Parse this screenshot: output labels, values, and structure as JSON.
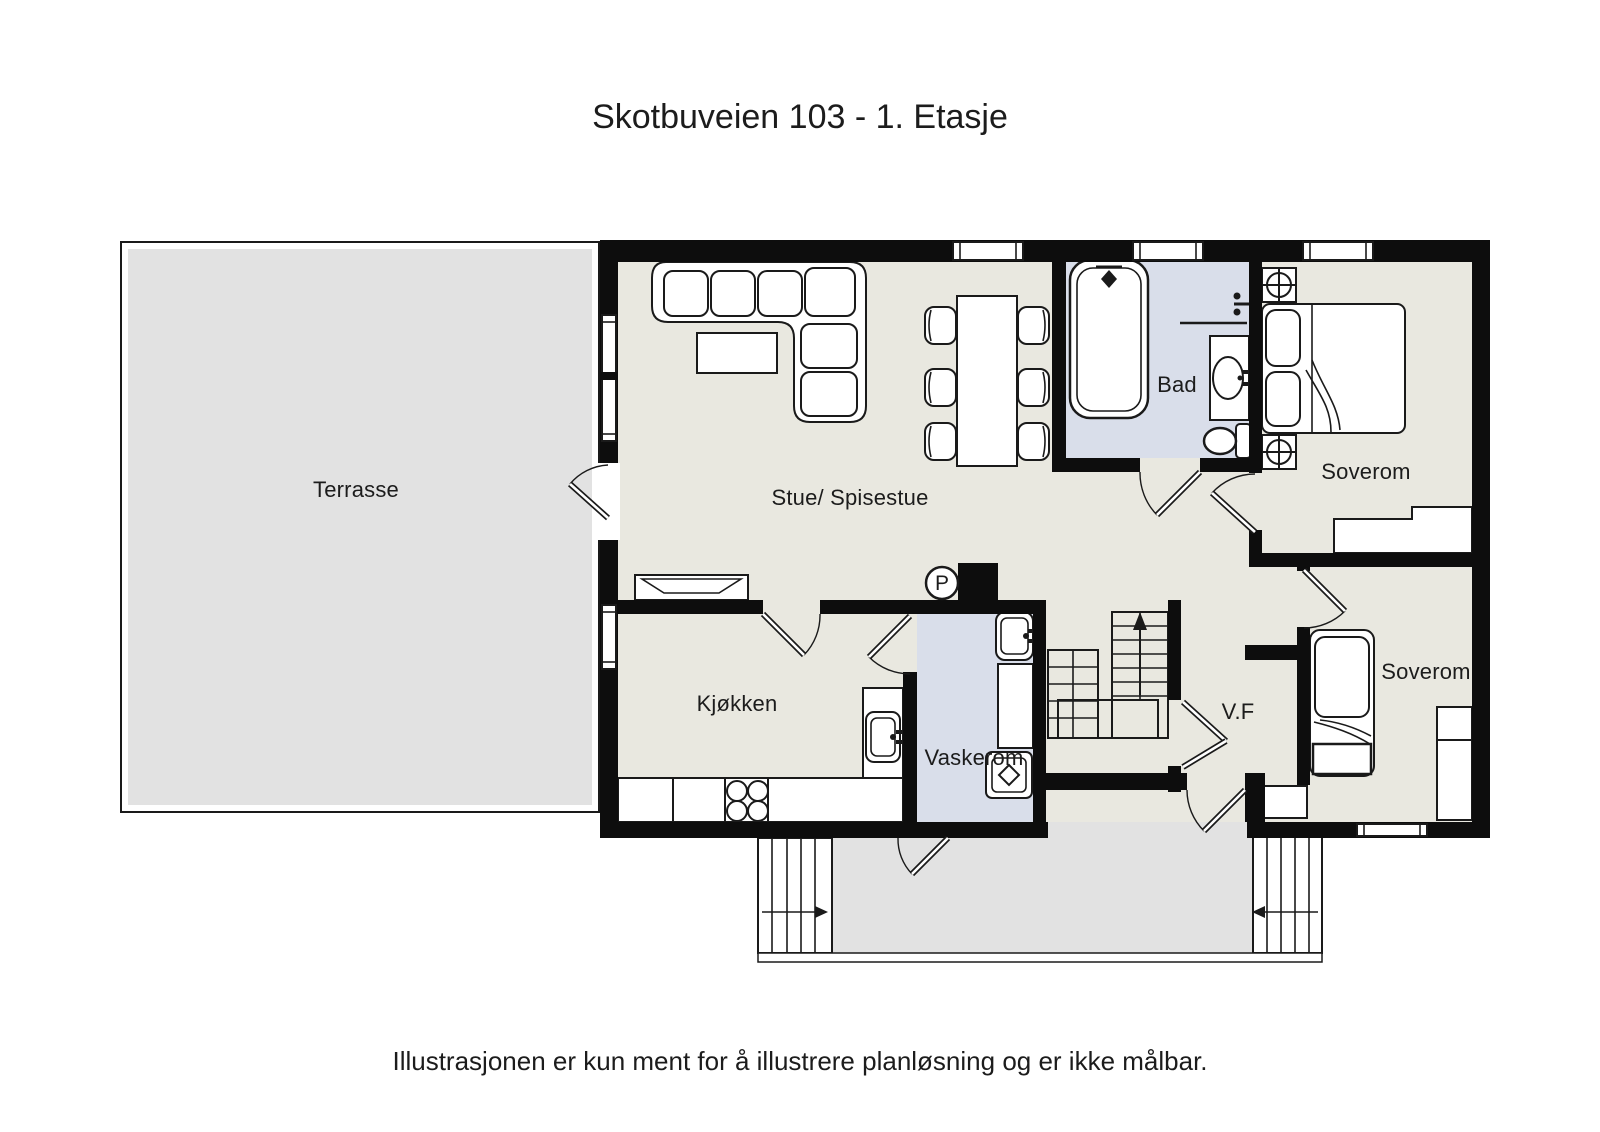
{
  "title": "Skotbuveien 103 - 1. Etasje",
  "disclaimer": "Illustrasjonen er kun ment for å illustrere planløsning og er ikke målbar.",
  "rooms": {
    "terrasse": {
      "label": "Terrasse"
    },
    "stue": {
      "label": "Stue/ Spisestue"
    },
    "bad": {
      "label": "Bad"
    },
    "soverom_top": {
      "label": "Soverom"
    },
    "kjokken": {
      "label": "Kjøkken"
    },
    "vaskerom": {
      "label": "Vaskerom"
    },
    "vf": {
      "label": "V.F"
    },
    "soverom_bottom": {
      "label": "Soverom"
    }
  },
  "symbols": {
    "chimney_label": "P"
  },
  "icons": [
    "bathtub-icon",
    "toilet-icon",
    "bathroom-sink-icon",
    "kitchen-sink-icon",
    "laundry-sink-icon",
    "stove-icon",
    "washing-machine-icon",
    "sofa-icon",
    "coffee-table-icon",
    "dining-table-icon",
    "chair-icon",
    "double-bed-icon",
    "single-bed-icon",
    "nightstand-lamp-icon",
    "wardrobe-icon",
    "stairs-icon",
    "door-icon",
    "window-icon",
    "chimney-icon"
  ],
  "colors": {
    "wall": "#0d0d0d",
    "line": "#1a1a1a",
    "floor": "#e9e8e0",
    "wet": "#d9deea",
    "outdoor": "#e2e2e2",
    "paper": "#ffffff",
    "text": "#1c1c1c"
  }
}
